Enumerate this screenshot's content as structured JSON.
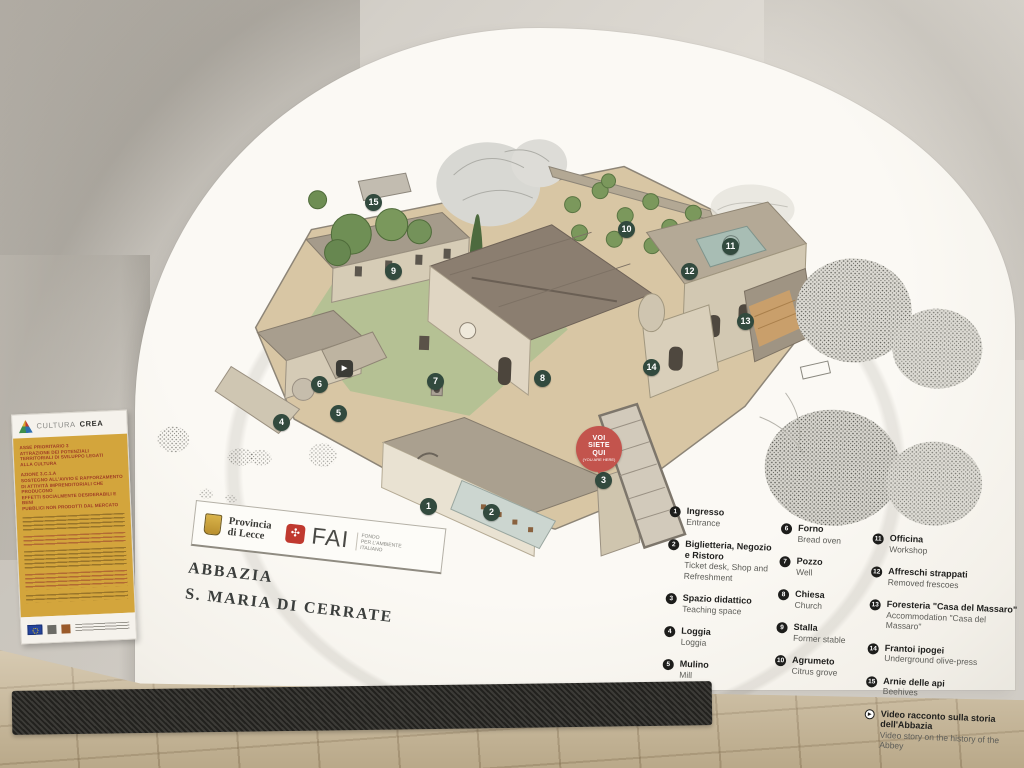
{
  "scene": {
    "description": "Photograph of a vaulted interior wall with a painted illustrated site map of the abbey grounds",
    "colors": {
      "wall": "#d8d4cd",
      "mural": "#faf8f3",
      "floor": "#c9b795",
      "marker_green": "#324a3e",
      "you_are_here_red": "#c3544d",
      "poster_yellow": "#d3a53c",
      "fai_red": "#c0392f"
    }
  },
  "poster": {
    "brand_light": "CULTURA",
    "brand_bold": "CREA",
    "block1": "ASSE PRIORITARIO 3\nATTRAZIONE DEI POTENZIALI\nTERRITORIALI DI SVILUPPO LEGATI\nALLA CULTURA",
    "block2": "AZIONE 3.C.1.A\nSOSTEGNO ALL'AVVIO E RAFFORZAMENTO\nDI ATTIVITÀ IMPRENDITORIALI CHE PRODUCONO\nEFFETTI SOCIALMENTE DESIDERABILI E BENI\nPUBBLICI NON PRODOTTI DAL MERCATO"
  },
  "sign": {
    "provincia": "Provincia\ndi Lecce",
    "fai": "FAI",
    "fai_sub": "FONDO\nPER L'AMBIENTE\nITALIANO",
    "title1": "ABBAZIA",
    "title2": "S. MARIA DI CERRATE"
  },
  "you_are_here": {
    "label": "VOI\nSIETE\nQUI",
    "sub": "(YOU ARE HERE)"
  },
  "map": {
    "markers": [
      {
        "num": "1",
        "x": 429,
        "y": 507
      },
      {
        "num": "2",
        "x": 492,
        "y": 513
      },
      {
        "num": "3",
        "x": 604,
        "y": 481
      },
      {
        "num": "4",
        "x": 282,
        "y": 423
      },
      {
        "num": "5",
        "x": 339,
        "y": 414
      },
      {
        "num": "6",
        "x": 320,
        "y": 385
      },
      {
        "num": "7",
        "x": 436,
        "y": 382
      },
      {
        "num": "8",
        "x": 543,
        "y": 379
      },
      {
        "num": "9",
        "x": 394,
        "y": 272
      },
      {
        "num": "10",
        "x": 627,
        "y": 230
      },
      {
        "num": "11",
        "x": 731,
        "y": 247
      },
      {
        "num": "12",
        "x": 690,
        "y": 272
      },
      {
        "num": "13",
        "x": 746,
        "y": 322
      },
      {
        "num": "14",
        "x": 652,
        "y": 368
      },
      {
        "num": "15",
        "x": 374,
        "y": 203
      },
      {
        "icon": "video",
        "x": 345,
        "y": 369
      }
    ]
  },
  "legend": {
    "columns": [
      {
        "items": [
          {
            "num": "1",
            "it": "Ingresso",
            "en": "Entrance"
          },
          {
            "num": "2",
            "it": "Biglietteria, Negozio e Ristoro",
            "en": "Ticket desk, Shop and Refreshment"
          },
          {
            "num": "3",
            "it": "Spazio didattico",
            "en": "Teaching space"
          },
          {
            "num": "4",
            "it": "Loggia",
            "en": "Loggia"
          },
          {
            "num": "5",
            "it": "Mulino",
            "en": "Mill"
          }
        ]
      },
      {
        "items": [
          {
            "num": "6",
            "it": "Forno",
            "en": "Bread oven"
          },
          {
            "num": "7",
            "it": "Pozzo",
            "en": "Well"
          },
          {
            "num": "8",
            "it": "Chiesa",
            "en": "Church"
          },
          {
            "num": "9",
            "it": "Stalla",
            "en": "Former stable"
          },
          {
            "num": "10",
            "it": "Agrumeto",
            "en": "Citrus grove"
          }
        ]
      },
      {
        "items": [
          {
            "num": "11",
            "it": "Officina",
            "en": "Workshop"
          },
          {
            "num": "12",
            "it": "Affreschi strappati",
            "en": "Removed frescoes"
          },
          {
            "num": "13",
            "it": "Foresteria \"Casa del Massaro\"",
            "en": "Accommodation \"Casa del Massaro\""
          },
          {
            "num": "14",
            "it": "Frantoi ipogei",
            "en": "Underground olive-press"
          },
          {
            "num": "15",
            "it": "Arnie delle api",
            "en": "Beehives"
          },
          {
            "icon": "video",
            "it": "Video racconto sulla storia dell'Abbazia",
            "en": "Video story on the history of the Abbey"
          }
        ]
      }
    ]
  }
}
